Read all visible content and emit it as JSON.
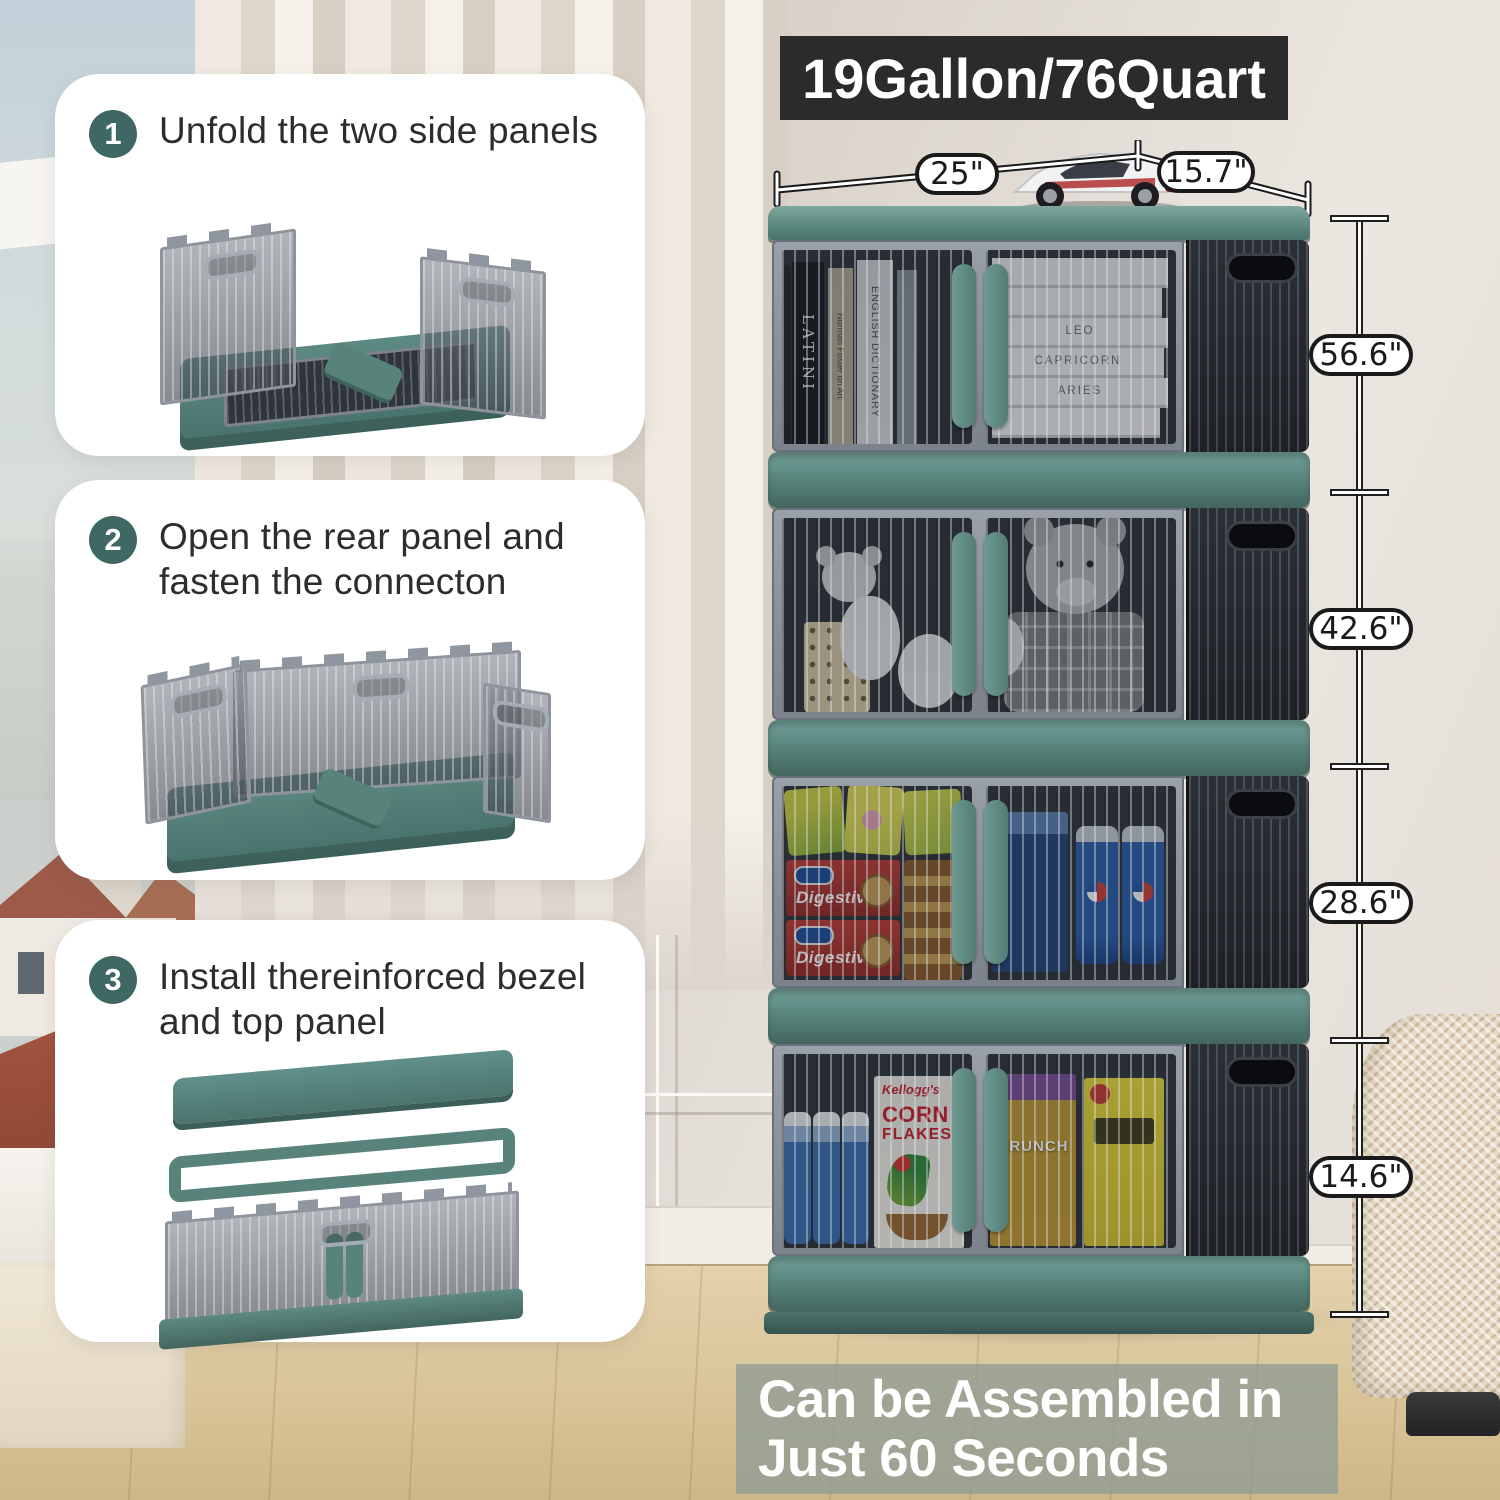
{
  "banner": {
    "text": "19Gallon/76Quart"
  },
  "steps": [
    {
      "number": "1",
      "text": "Unfold the two side panels"
    },
    {
      "number": "2",
      "text": "Open the rear panel and fasten the connecton"
    },
    {
      "number": "3",
      "text": "Install thereinforced bezel and top panel"
    }
  ],
  "dimensions": {
    "width": "25\"",
    "depth": "15.7\"",
    "heights": [
      "56.6\"",
      "42.6\"",
      "28.6\"",
      "14.6\""
    ]
  },
  "caption": {
    "line1": "Can be Assembled in",
    "line2": "Just 60 Seconds"
  },
  "cabinet": {
    "tier1": {
      "spine1": "LATINI",
      "spine2": "Norman Foster on Art",
      "spine3": "ENGLISH DICTIONARY",
      "stack1": "LEO",
      "stack2": "CAPRICORN",
      "stack3": "ARIES"
    },
    "tier3": {
      "box1": "Digestive",
      "box2": "Digestive"
    },
    "tier4": {
      "brand": "Kellogg's",
      "cereal1": "CORN",
      "cereal2": "FLAKES",
      "crunch": "CRUNCH"
    }
  },
  "colors": {
    "teal": "#57837b",
    "teal_dark": "#43665f",
    "banner_bg": "#2b2b2b",
    "step_circle": "#3f6763",
    "caption_bg": "#939d95",
    "smoke_panel": "#2e333a"
  }
}
